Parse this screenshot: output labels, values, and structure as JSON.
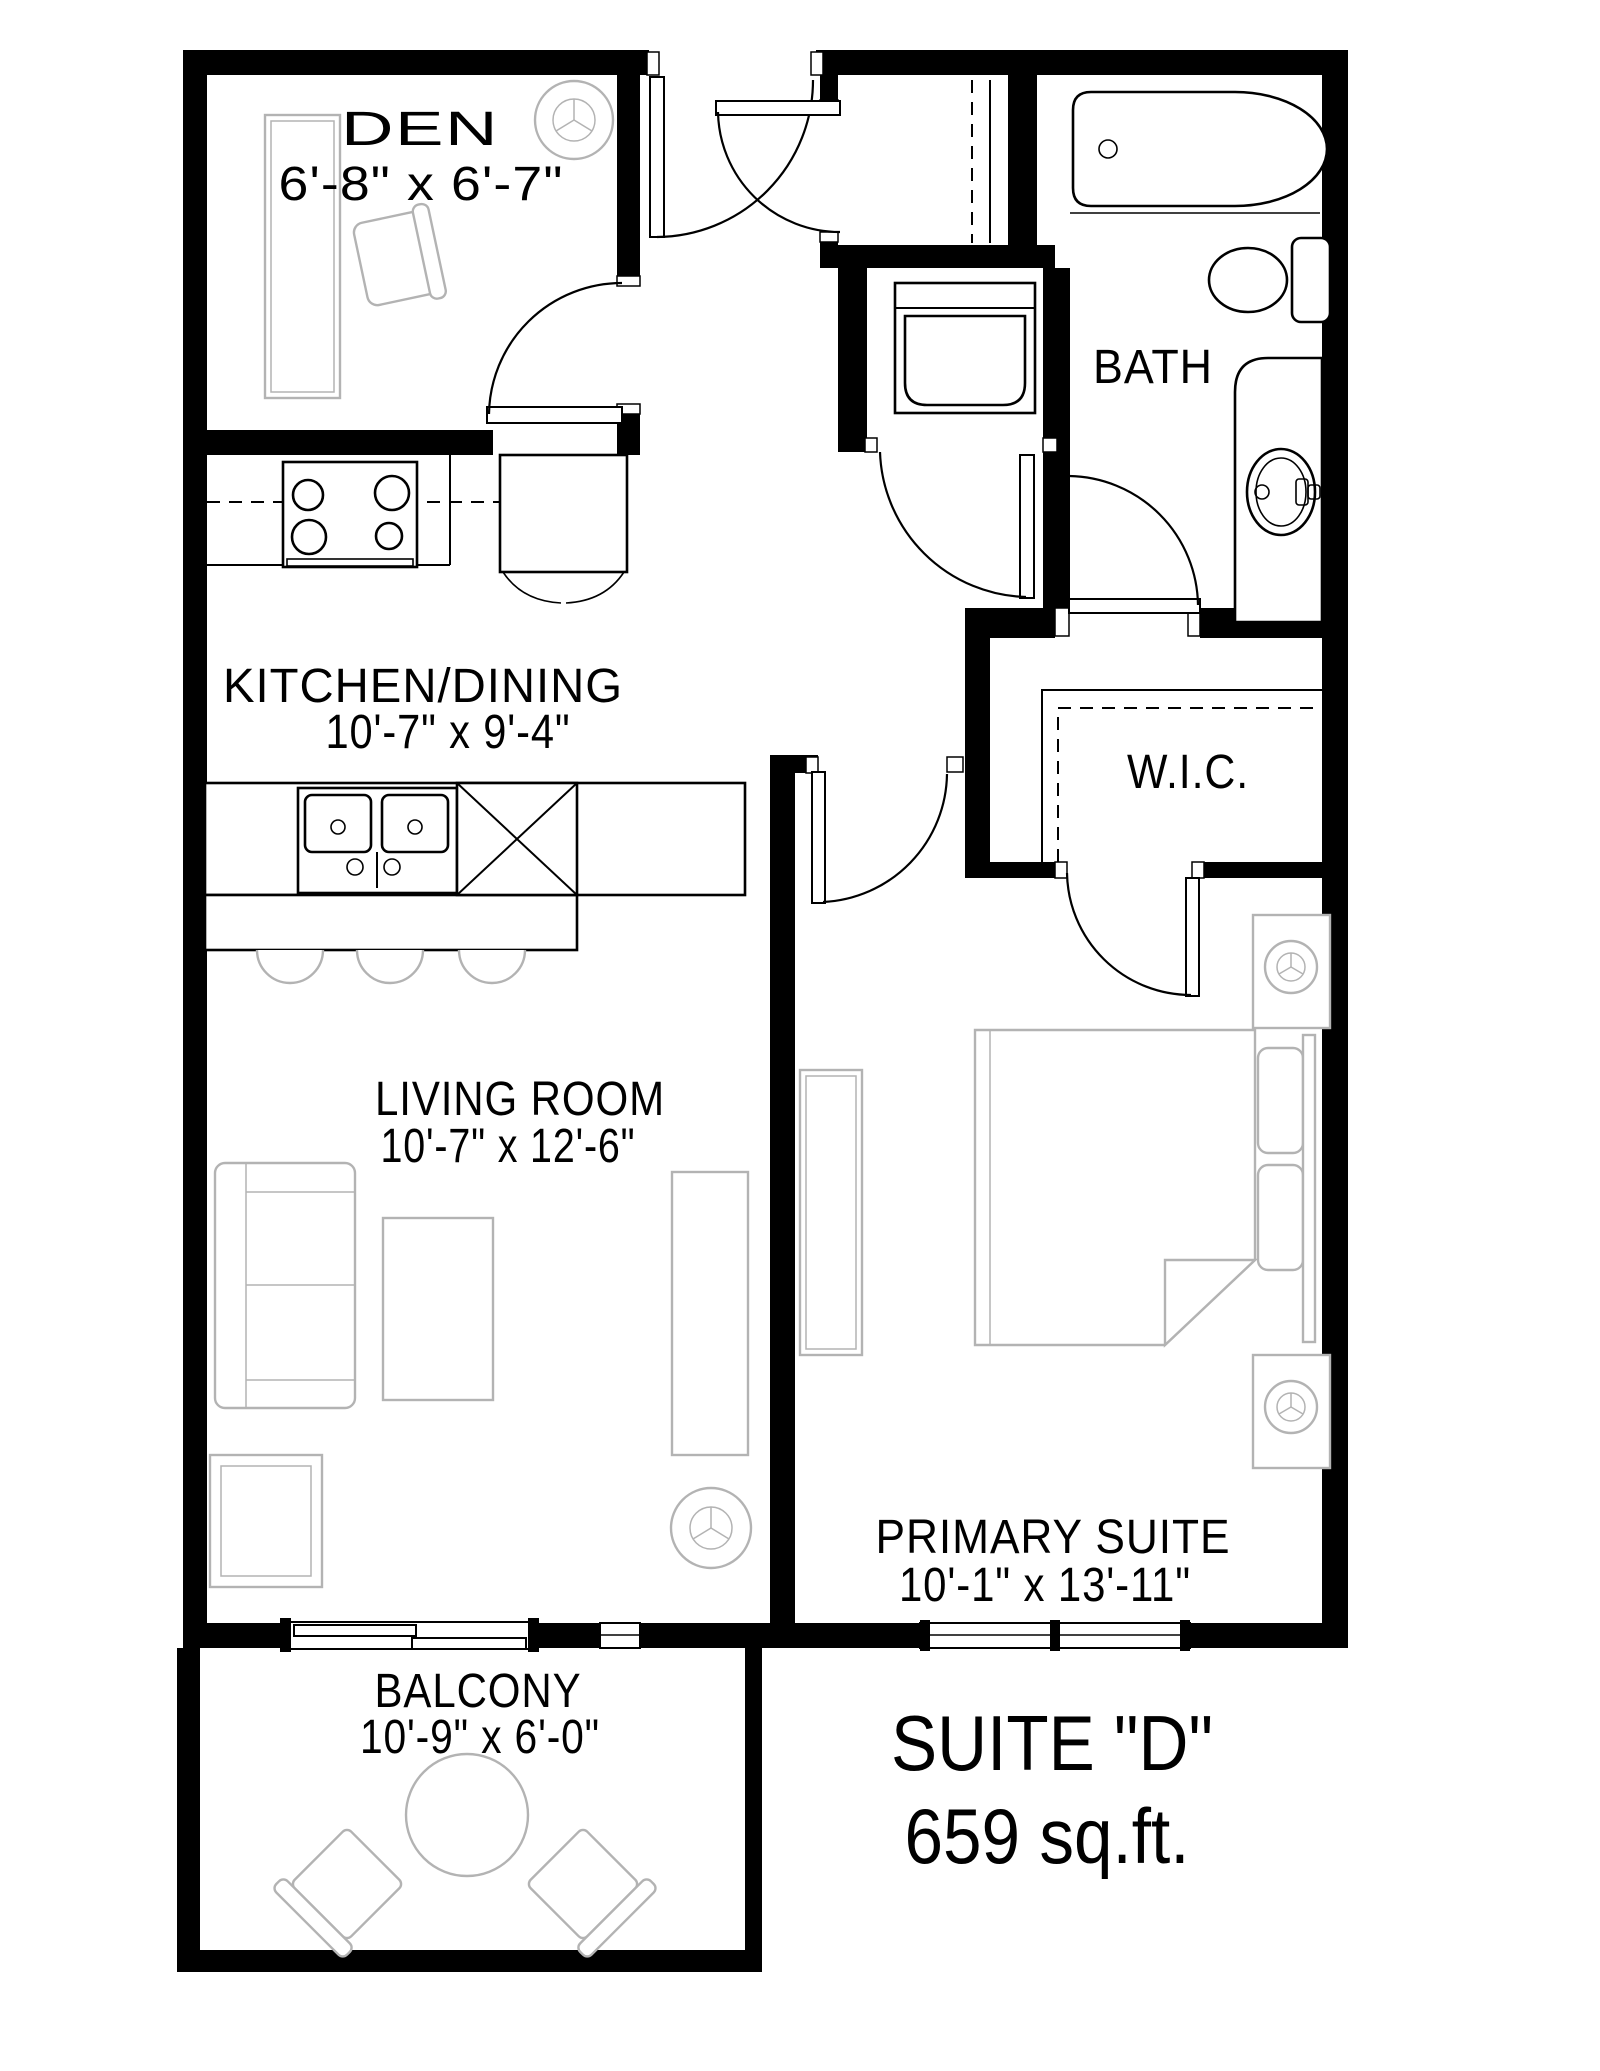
{
  "plan": {
    "suite_label": "SUITE \"D\"",
    "suite_area": "659 sq.ft.",
    "rooms": [
      {
        "name": "DEN",
        "dims": "6'-8\" x 6'-7\""
      },
      {
        "name": "BATH",
        "dims": ""
      },
      {
        "name": "KITCHEN/DINING",
        "dims": "10'-7\" x 9'-4\""
      },
      {
        "name": "W.I.C.",
        "dims": ""
      },
      {
        "name": "LIVING ROOM",
        "dims": "10'-7\" x 12'-6\""
      },
      {
        "name": "PRIMARY SUITE",
        "dims": "10'-1\" x 13'-11\""
      },
      {
        "name": "BALCONY",
        "dims": "10'-9\" x 6'-0\""
      }
    ],
    "colors": {
      "wall": "#000000",
      "furniture": "#b3b3b3",
      "background": "#ffffff"
    }
  }
}
